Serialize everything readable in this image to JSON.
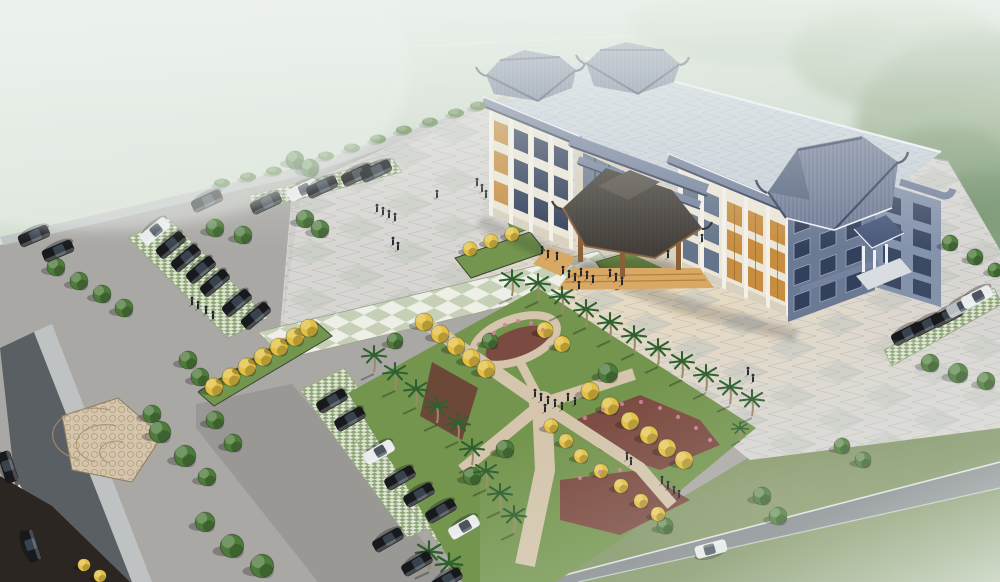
{
  "meta": {
    "description": "Aerial perspective rendering of a three-story Chinese-style government office building with blue-gray tiled pavilion roofs, a large paved forecourt plaza with figures, an X-shaped mosaic garden path lined with yellow trees and palms, angled parking lots with dark sedans, perimeter roads, and a misty green background."
  },
  "colors": {
    "sky1": "#dde6dc",
    "sky2": "#ccd8ca",
    "sky3": "#b5c5ae",
    "forest": "#8aa37e",
    "forest_dark": "#70906a",
    "contrail": "#ffffff",
    "base": "#aaa8a5",
    "lot_light": "#bcbab6",
    "plaza": "#d8d6d3",
    "plaza_checker": "#c2c6bf",
    "grid": "#b6b9b6",
    "warm_glow": "#f3dcb4",
    "road": "#84898d",
    "road_dark": "#5a5f64",
    "sidewalk": "#bfc2c2",
    "curb": "#e2e4e3",
    "soil_dark": "#2b2622",
    "drive": "#9a9894",
    "checker_green": "#c6d0b7",
    "checker_white": "#eef0e8",
    "grassgrid_bg": "#e0e5d7",
    "grassgrid_dot": "#8ea674",
    "mosaic": "#d4c5ac",
    "mosaic_line": "#a8906e",
    "lawn": "#74954e",
    "lawn_dark": "#42543a",
    "grass_field": "#7e9363",
    "grass_field2": "#9aab81",
    "mulch": "#6b4838",
    "mulch_red": "#7b4a40",
    "flower_pink": "#cf8298",
    "roof_flat": "#c9d2db",
    "roof_flat_line": "#aab7c5",
    "roof_tile": "#76829e",
    "roof_tile_dark": "#39415a",
    "roof_gable": "#5a6782",
    "roof_edge": "#eef2f7",
    "facade": "#ebe6d8",
    "facade_shade": "#d8d1bf",
    "pilaster": "#f3f0e7",
    "win_dark": "#33405c",
    "win_glass": "#64748a",
    "win_frame": "#c5cdd8",
    "lattice": "#c78e42",
    "lattice_dark": "#9a6c26",
    "wing_face": "#6a7994",
    "wing_side": "#8492ac",
    "wing_dark": "#49577a",
    "canopy": "#45403a",
    "canopy_edge": "#2d2926",
    "wood": "#8a6038",
    "step": "#d8a865",
    "step_dark": "#b97f3f",
    "car_dark": "#17191d",
    "car_white": "#e9ebec",
    "car_silver": "#b6bcc1",
    "car_glass": "#3d4752",
    "tree_green": "#4d7b3a",
    "tree_yellow": "#e3c043",
    "palm": "#2e6030",
    "trunk": "#9b8a6a",
    "shrub": "#5e8448",
    "person": "#23262e",
    "mist": "#eef3ee"
  },
  "scene": {
    "cars": [
      {
        "x": 34,
        "y": 236,
        "c": "dark",
        "r": 157
      },
      {
        "x": 58,
        "y": 251,
        "c": "dark",
        "r": 157
      },
      {
        "x": 155,
        "y": 231,
        "c": "white",
        "r": 140
      },
      {
        "x": 171,
        "y": 245,
        "c": "dark",
        "r": 140
      },
      {
        "x": 186,
        "y": 258,
        "c": "dark",
        "r": 140
      },
      {
        "x": 201,
        "y": 270,
        "c": "dark",
        "r": 140
      },
      {
        "x": 215,
        "y": 283,
        "c": "dark",
        "r": 140
      },
      {
        "x": 237,
        "y": 303,
        "c": "dark",
        "r": 140
      },
      {
        "x": 256,
        "y": 316,
        "c": "dark",
        "r": 140
      },
      {
        "x": 207,
        "y": 201,
        "c": "dark",
        "r": 155
      },
      {
        "x": 266,
        "y": 203,
        "c": "dark",
        "r": 155
      },
      {
        "x": 303,
        "y": 190,
        "c": "white",
        "r": 155
      },
      {
        "x": 322,
        "y": 187,
        "c": "dark",
        "r": 155
      },
      {
        "x": 357,
        "y": 175,
        "c": "dark",
        "r": 155
      },
      {
        "x": 376,
        "y": 171,
        "c": "dark",
        "r": 155
      },
      {
        "x": 332,
        "y": 401,
        "c": "dark",
        "r": 150
      },
      {
        "x": 350,
        "y": 419,
        "c": "dark",
        "r": 150
      },
      {
        "x": 379,
        "y": 452,
        "c": "white",
        "r": 150
      },
      {
        "x": 400,
        "y": 478,
        "c": "dark",
        "r": 150
      },
      {
        "x": 419,
        "y": 495,
        "c": "dark",
        "r": 150
      },
      {
        "x": 441,
        "y": 511,
        "c": "dark",
        "r": 150
      },
      {
        "x": 464,
        "y": 527,
        "c": "white",
        "r": 150
      },
      {
        "x": 388,
        "y": 540,
        "c": "dark",
        "r": 150
      },
      {
        "x": 417,
        "y": 564,
        "c": "dark",
        "r": 150
      },
      {
        "x": 447,
        "y": 580,
        "c": "dark",
        "r": 150
      },
      {
        "x": 907,
        "y": 334,
        "c": "dark",
        "r": 153
      },
      {
        "x": 927,
        "y": 325,
        "c": "dark",
        "r": 153
      },
      {
        "x": 947,
        "y": 316,
        "c": "dark",
        "r": 153
      },
      {
        "x": 962,
        "y": 306,
        "c": "silver",
        "r": 153
      },
      {
        "x": 977,
        "y": 297,
        "c": "white",
        "r": 153
      },
      {
        "x": 31,
        "y": 546,
        "c": "dark",
        "r": 72
      },
      {
        "x": 8,
        "y": 467,
        "c": "dark",
        "r": 72
      },
      {
        "x": 711,
        "y": 549,
        "c": "white",
        "r": -15
      }
    ],
    "trees": [
      {
        "x": 56,
        "y": 267
      },
      {
        "x": 79,
        "y": 281
      },
      {
        "x": 102,
        "y": 294
      },
      {
        "x": 124,
        "y": 308
      },
      {
        "x": 215,
        "y": 228
      },
      {
        "x": 243,
        "y": 235
      },
      {
        "x": 305,
        "y": 219
      },
      {
        "x": 320,
        "y": 229
      },
      {
        "x": 295,
        "y": 160
      },
      {
        "x": 310,
        "y": 168
      },
      {
        "x": 188,
        "y": 360
      },
      {
        "x": 200,
        "y": 377
      },
      {
        "x": 215,
        "y": 420
      },
      {
        "x": 233,
        "y": 443
      },
      {
        "x": 152,
        "y": 414
      },
      {
        "x": 160,
        "y": 432,
        "s": 1.2
      },
      {
        "x": 185,
        "y": 456,
        "s": 1.2
      },
      {
        "x": 207,
        "y": 477
      },
      {
        "x": 205,
        "y": 522,
        "s": 1.1
      },
      {
        "x": 232,
        "y": 546,
        "s": 1.3
      },
      {
        "x": 262,
        "y": 566,
        "s": 1.3
      },
      {
        "x": 930,
        "y": 363
      },
      {
        "x": 958,
        "y": 373,
        "s": 1.1
      },
      {
        "x": 986,
        "y": 381
      },
      {
        "x": 842,
        "y": 446,
        "s": 0.9
      },
      {
        "x": 863,
        "y": 460,
        "s": 0.9
      },
      {
        "x": 762,
        "y": 496
      },
      {
        "x": 778,
        "y": 516
      },
      {
        "x": 665,
        "y": 526,
        "s": 0.9
      },
      {
        "x": 395,
        "y": 341,
        "s": 0.9
      },
      {
        "x": 472,
        "y": 476
      },
      {
        "x": 505,
        "y": 449
      },
      {
        "x": 608,
        "y": 373,
        "s": 1.1
      },
      {
        "x": 490,
        "y": 341,
        "s": 0.9
      },
      {
        "x": 950,
        "y": 243,
        "s": 0.9
      },
      {
        "x": 975,
        "y": 257,
        "s": 0.9
      },
      {
        "x": 995,
        "y": 270,
        "s": 0.8
      },
      {
        "x": 214,
        "y": 387,
        "v": "yellow"
      },
      {
        "x": 231,
        "y": 377,
        "v": "yellow"
      },
      {
        "x": 247,
        "y": 367,
        "v": "yellow"
      },
      {
        "x": 263,
        "y": 357,
        "v": "yellow"
      },
      {
        "x": 279,
        "y": 347,
        "v": "yellow"
      },
      {
        "x": 295,
        "y": 337,
        "v": "yellow"
      },
      {
        "x": 309,
        "y": 328,
        "v": "yellow"
      },
      {
        "x": 424,
        "y": 322,
        "v": "yellow"
      },
      {
        "x": 440,
        "y": 334,
        "v": "yellow"
      },
      {
        "x": 456,
        "y": 346,
        "v": "yellow"
      },
      {
        "x": 471,
        "y": 358,
        "v": "yellow"
      },
      {
        "x": 486,
        "y": 369,
        "v": "yellow"
      },
      {
        "x": 590,
        "y": 391,
        "v": "yellow"
      },
      {
        "x": 610,
        "y": 406,
        "v": "yellow"
      },
      {
        "x": 630,
        "y": 421,
        "v": "yellow"
      },
      {
        "x": 649,
        "y": 435,
        "v": "yellow"
      },
      {
        "x": 667,
        "y": 448,
        "v": "yellow"
      },
      {
        "x": 684,
        "y": 460,
        "v": "yellow"
      },
      {
        "x": 551,
        "y": 426,
        "v": "yellow",
        "s": 0.8
      },
      {
        "x": 566,
        "y": 441,
        "v": "yellow",
        "s": 0.8
      },
      {
        "x": 581,
        "y": 456,
        "v": "yellow",
        "s": 0.8
      },
      {
        "x": 601,
        "y": 471,
        "v": "yellow",
        "s": 0.8
      },
      {
        "x": 621,
        "y": 486,
        "v": "yellow",
        "s": 0.8
      },
      {
        "x": 641,
        "y": 501,
        "v": "yellow",
        "s": 0.8
      },
      {
        "x": 658,
        "y": 514,
        "v": "yellow",
        "s": 0.8
      },
      {
        "x": 470,
        "y": 249,
        "v": "yellow",
        "s": 0.8
      },
      {
        "x": 491,
        "y": 241,
        "v": "yellow",
        "s": 0.8
      },
      {
        "x": 512,
        "y": 234,
        "v": "yellow",
        "s": 0.8
      },
      {
        "x": 545,
        "y": 330,
        "v": "yellow",
        "s": 0.9
      },
      {
        "x": 562,
        "y": 344,
        "v": "yellow",
        "s": 0.9
      },
      {
        "x": 84,
        "y": 565,
        "v": "yellow",
        "s": 0.7
      },
      {
        "x": 100,
        "y": 576,
        "v": "yellow",
        "s": 0.7
      }
    ],
    "palms": [
      {
        "x": 512,
        "y": 296
      },
      {
        "x": 538,
        "y": 300
      },
      {
        "x": 562,
        "y": 313
      },
      {
        "x": 586,
        "y": 326
      },
      {
        "x": 610,
        "y": 339
      },
      {
        "x": 634,
        "y": 352
      },
      {
        "x": 658,
        "y": 365
      },
      {
        "x": 682,
        "y": 378
      },
      {
        "x": 706,
        "y": 391
      },
      {
        "x": 730,
        "y": 404
      },
      {
        "x": 752,
        "y": 416
      },
      {
        "x": 374,
        "y": 372
      },
      {
        "x": 395,
        "y": 389
      },
      {
        "x": 416,
        "y": 406
      },
      {
        "x": 437,
        "y": 423
      },
      {
        "x": 458,
        "y": 440
      },
      {
        "x": 472,
        "y": 465
      },
      {
        "x": 486,
        "y": 488
      },
      {
        "x": 500,
        "y": 510
      },
      {
        "x": 514,
        "y": 532
      },
      {
        "x": 429,
        "y": 570,
        "s": 1.1
      },
      {
        "x": 449,
        "y": 582,
        "s": 1.1
      },
      {
        "x": 740,
        "y": 440,
        "s": 0.7
      }
    ],
    "shrubs": [
      {
        "x": 222,
        "y": 183
      },
      {
        "x": 248,
        "y": 177
      },
      {
        "x": 274,
        "y": 171
      },
      {
        "x": 300,
        "y": 165
      },
      {
        "x": 326,
        "y": 156
      },
      {
        "x": 352,
        "y": 148
      },
      {
        "x": 378,
        "y": 139
      },
      {
        "x": 404,
        "y": 130
      },
      {
        "x": 430,
        "y": 122
      },
      {
        "x": 456,
        "y": 113
      },
      {
        "x": 478,
        "y": 106
      }
    ],
    "people": [
      {
        "x": 377,
        "y": 210
      },
      {
        "x": 383,
        "y": 213
      },
      {
        "x": 389,
        "y": 216
      },
      {
        "x": 395,
        "y": 219
      },
      {
        "x": 437,
        "y": 196
      },
      {
        "x": 393,
        "y": 243
      },
      {
        "x": 398,
        "y": 248
      },
      {
        "x": 477,
        "y": 184
      },
      {
        "x": 482,
        "y": 190
      },
      {
        "x": 486,
        "y": 196
      },
      {
        "x": 542,
        "y": 252
      },
      {
        "x": 548,
        "y": 256
      },
      {
        "x": 557,
        "y": 258
      },
      {
        "x": 563,
        "y": 272
      },
      {
        "x": 569,
        "y": 276
      },
      {
        "x": 575,
        "y": 279
      },
      {
        "x": 581,
        "y": 274
      },
      {
        "x": 587,
        "y": 277
      },
      {
        "x": 593,
        "y": 281
      },
      {
        "x": 579,
        "y": 287
      },
      {
        "x": 610,
        "y": 275
      },
      {
        "x": 616,
        "y": 279
      },
      {
        "x": 622,
        "y": 283
      },
      {
        "x": 668,
        "y": 256
      },
      {
        "x": 702,
        "y": 240
      },
      {
        "x": 535,
        "y": 395
      },
      {
        "x": 541,
        "y": 399
      },
      {
        "x": 548,
        "y": 402
      },
      {
        "x": 555,
        "y": 405
      },
      {
        "x": 562,
        "y": 408
      },
      {
        "x": 568,
        "y": 399
      },
      {
        "x": 575,
        "y": 403
      },
      {
        "x": 545,
        "y": 410
      },
      {
        "x": 627,
        "y": 458
      },
      {
        "x": 631,
        "y": 463
      },
      {
        "x": 662,
        "y": 482
      },
      {
        "x": 668,
        "y": 487
      },
      {
        "x": 674,
        "y": 492
      },
      {
        "x": 679,
        "y": 496
      },
      {
        "x": 748,
        "y": 373
      },
      {
        "x": 753,
        "y": 380
      },
      {
        "x": 192,
        "y": 303
      },
      {
        "x": 198,
        "y": 307
      },
      {
        "x": 206,
        "y": 312
      },
      {
        "x": 213,
        "y": 317
      }
    ],
    "flowers": [
      {
        "x": 505,
        "y": 325
      },
      {
        "x": 518,
        "y": 321
      },
      {
        "x": 531,
        "y": 323
      },
      {
        "x": 543,
        "y": 330
      },
      {
        "x": 494,
        "y": 333
      },
      {
        "x": 585,
        "y": 418
      },
      {
        "x": 603,
        "y": 410
      },
      {
        "x": 622,
        "y": 404
      },
      {
        "x": 641,
        "y": 402
      },
      {
        "x": 660,
        "y": 408
      },
      {
        "x": 678,
        "y": 417
      },
      {
        "x": 696,
        "y": 428
      },
      {
        "x": 710,
        "y": 440
      },
      {
        "x": 580,
        "y": 478
      },
      {
        "x": 600,
        "y": 472
      },
      {
        "x": 620,
        "y": 470
      }
    ]
  }
}
